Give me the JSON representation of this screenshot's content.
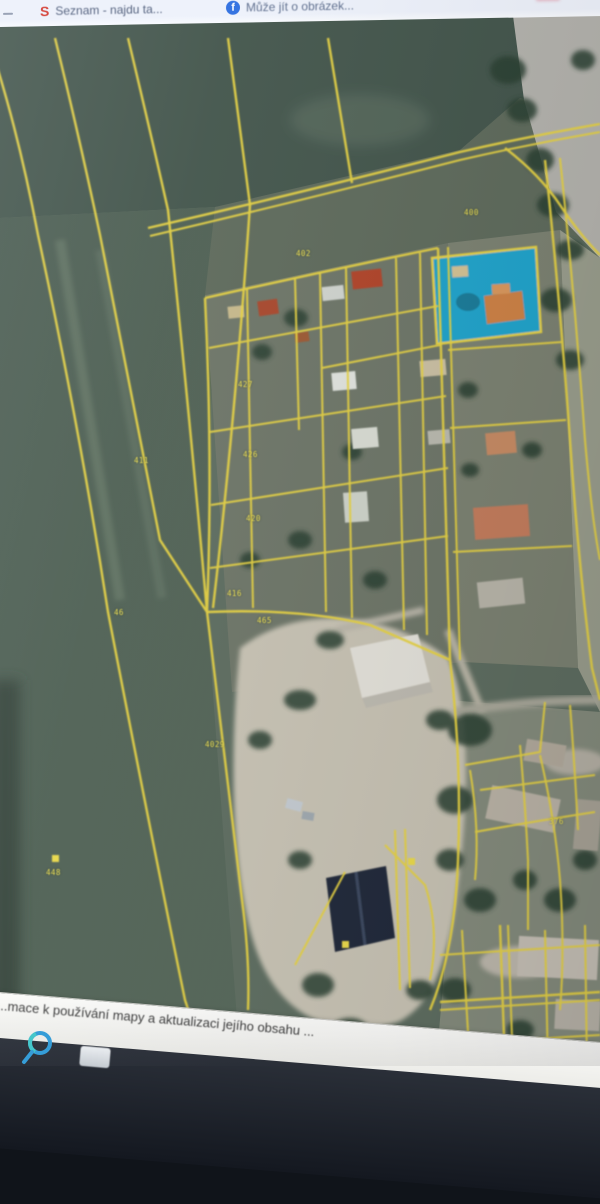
{
  "browser": {
    "tab_bar": {
      "tabs": [
        {
          "title": "Seznam - najdu ta...",
          "icon": "seznam-icon",
          "icon_letter": "S",
          "icon_color": "#d4372c"
        },
        {
          "title": "Může jít o obrázek...",
          "icon": "facebook-icon",
          "icon_letter": "f",
          "icon_color": "#2e6fe0"
        }
      ]
    }
  },
  "map": {
    "kind": "cadastral-aerial-orthophoto",
    "parcel_line_color": "#e6d243",
    "highlighted_parcel_color": "#18a7d4",
    "parcel_labels": [
      {
        "text": "402",
        "x": 296,
        "y": 249
      },
      {
        "text": "400",
        "x": 464,
        "y": 208
      },
      {
        "text": "427",
        "x": 238,
        "y": 380
      },
      {
        "text": "411",
        "x": 134,
        "y": 456
      },
      {
        "text": "426",
        "x": 243,
        "y": 450
      },
      {
        "text": "420",
        "x": 246,
        "y": 514
      },
      {
        "text": "416",
        "x": 227,
        "y": 589
      },
      {
        "text": "465",
        "x": 257,
        "y": 616
      },
      {
        "text": "46",
        "x": 114,
        "y": 608
      },
      {
        "text": "4029",
        "x": 205,
        "y": 740
      },
      {
        "text": "448",
        "x": 46,
        "y": 868
      },
      {
        "text": "376",
        "x": 549,
        "y": 817
      }
    ],
    "footer": {
      "text": "...mace k používání mapy a aktualizaci jejího obsahu ..."
    }
  },
  "taskbar": {
    "icons": [
      {
        "name": "search-icon"
      },
      {
        "name": "app-tile-icon"
      }
    ]
  }
}
